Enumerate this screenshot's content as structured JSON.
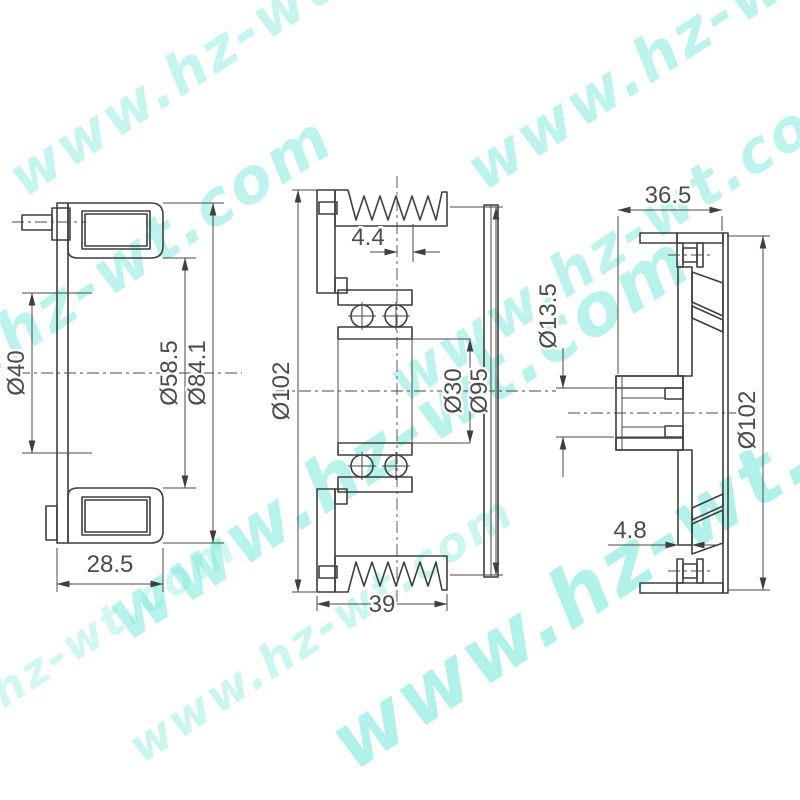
{
  "drawing": {
    "type": "technical-drawing",
    "subject": "compressor electromagnetic clutch pulley sectional views",
    "background": "#ffffff",
    "line_color": "#3f3f3f",
    "watermark": {
      "text": "www.hz-wt.com",
      "color": "#7de9dc"
    },
    "views": {
      "coil": {
        "label": "coil-assembly-section",
        "dims": {
          "inner_dia": "Ø40",
          "mid_dia": "Ø58.5",
          "outer_dia": "Ø84.1",
          "width": "28.5"
        }
      },
      "pulley": {
        "label": "pulley-bearing-section",
        "dims": {
          "groove_offset": "4.4",
          "outer_dia": "Ø102",
          "bore_dia": "Ø30",
          "flange_dia": "Ø95",
          "width": "39"
        }
      },
      "hub": {
        "label": "clutch-hub-section",
        "dims": {
          "width": "36.5",
          "bore_dia": "Ø13.5",
          "outer_dia": "Ø102",
          "plate_thickness": "4.8"
        }
      }
    }
  }
}
